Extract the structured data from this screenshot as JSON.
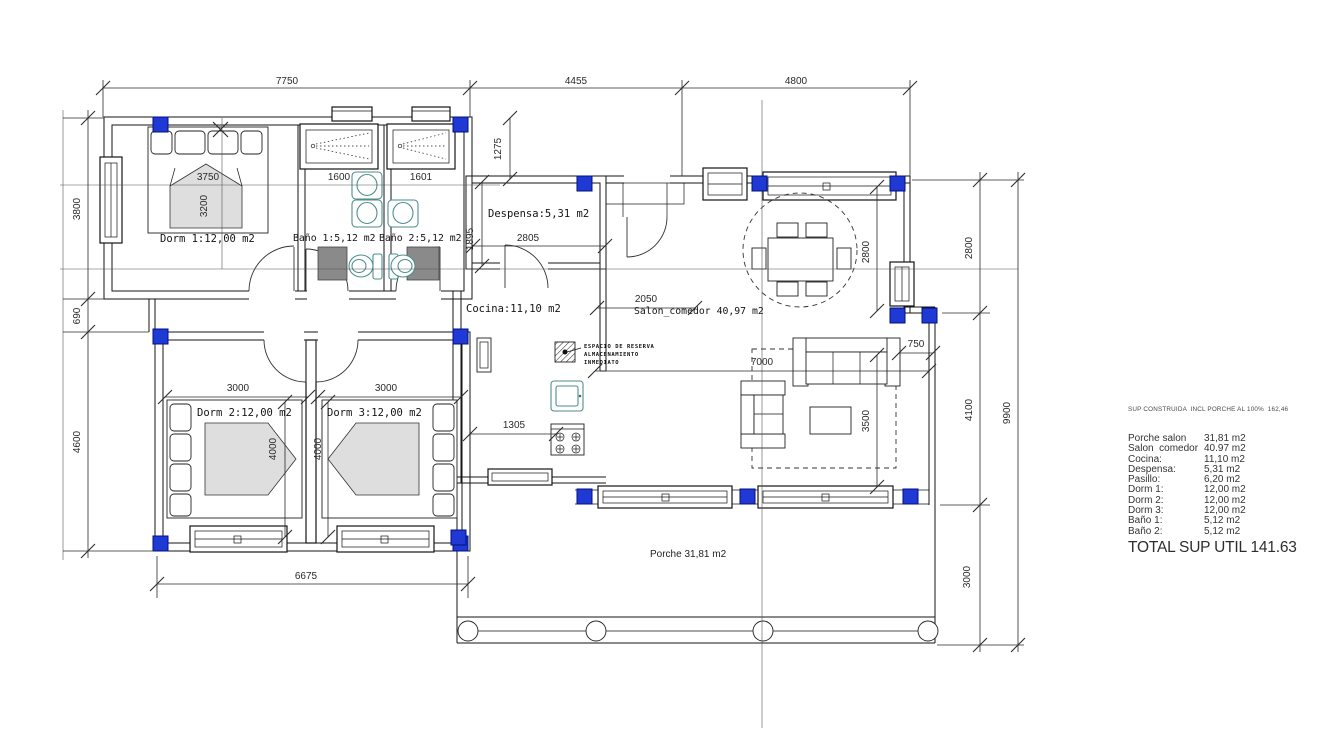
{
  "colors": {
    "pillar": "#2038d4",
    "pillar_border": "#001080",
    "fixture_teal": "#4e8e8e",
    "tray_gray": "#8a8a8a",
    "bed_gray": "#dedede",
    "line": "#151515"
  },
  "rooms": {
    "dorm1": "Dorm 1:12,00 m2",
    "bano1": "Baño 1:5,12 m2",
    "bano2": "Baño 2:5,12 m2",
    "despensa": "Despensa:5,31 m2",
    "cocina": "Cocina:11,10 m2",
    "salon": "Salon_comedor 40,97 m2",
    "dorm2": "Dorm 2:12,00 m2",
    "dorm3": "Dorm 3:12,00 m2",
    "porche": "Porche 31,81 m2",
    "reserva_line1": "ESPACIO DE RESERVA",
    "reserva_line2": "ALMACENAMIENTO",
    "reserva_line3": "INMEDIATO"
  },
  "dims": {
    "top": [
      "7750",
      "4455",
      "4800"
    ],
    "left": [
      "3800",
      "690",
      "4600"
    ],
    "right": [
      "2800",
      "4100",
      "3000",
      "9900"
    ],
    "bottom": [
      "6675"
    ],
    "interior": {
      "d1275": "1275",
      "d1895": "1895",
      "d2805": "2805",
      "d2050": "2050",
      "d1305": "1305",
      "d7000": "7000",
      "d750": "750",
      "d3500": "3500",
      "d2800": "2800",
      "d3000a": "3000",
      "d3000b": "3000",
      "d4000a": "4000",
      "d4000b": "4000",
      "d3750": "3750",
      "d3200": "3200",
      "w1600": "1600",
      "w1601": "1601"
    }
  },
  "summary": {
    "header": "SUP CONSTRUIDA  INCL PORCHE AL 100%  162,46",
    "rows": [
      {
        "label": "Porche salon",
        "value": "31,81 m2"
      },
      {
        "label": "Salon  comedor",
        "value": "40.97 m2"
      },
      {
        "label": "Cocina:",
        "value": "11,10 m2"
      },
      {
        "label": "Despensa:",
        "value": "5,31 m2"
      },
      {
        "label": "Pasillo:",
        "value": "6,20 m2"
      },
      {
        "label": "Dorm 1:",
        "value": "12,00 m2"
      },
      {
        "label": "Dorm 2:",
        "value": "12,00 m2"
      },
      {
        "label": "Dorm 3:",
        "value": "12,00 m2"
      },
      {
        "label": "Baño 1:",
        "value": "5,12 m2"
      },
      {
        "label": "Baño 2:",
        "value": "5,12 m2"
      }
    ],
    "total": "TOTAL SUP UTIL 141.63"
  }
}
